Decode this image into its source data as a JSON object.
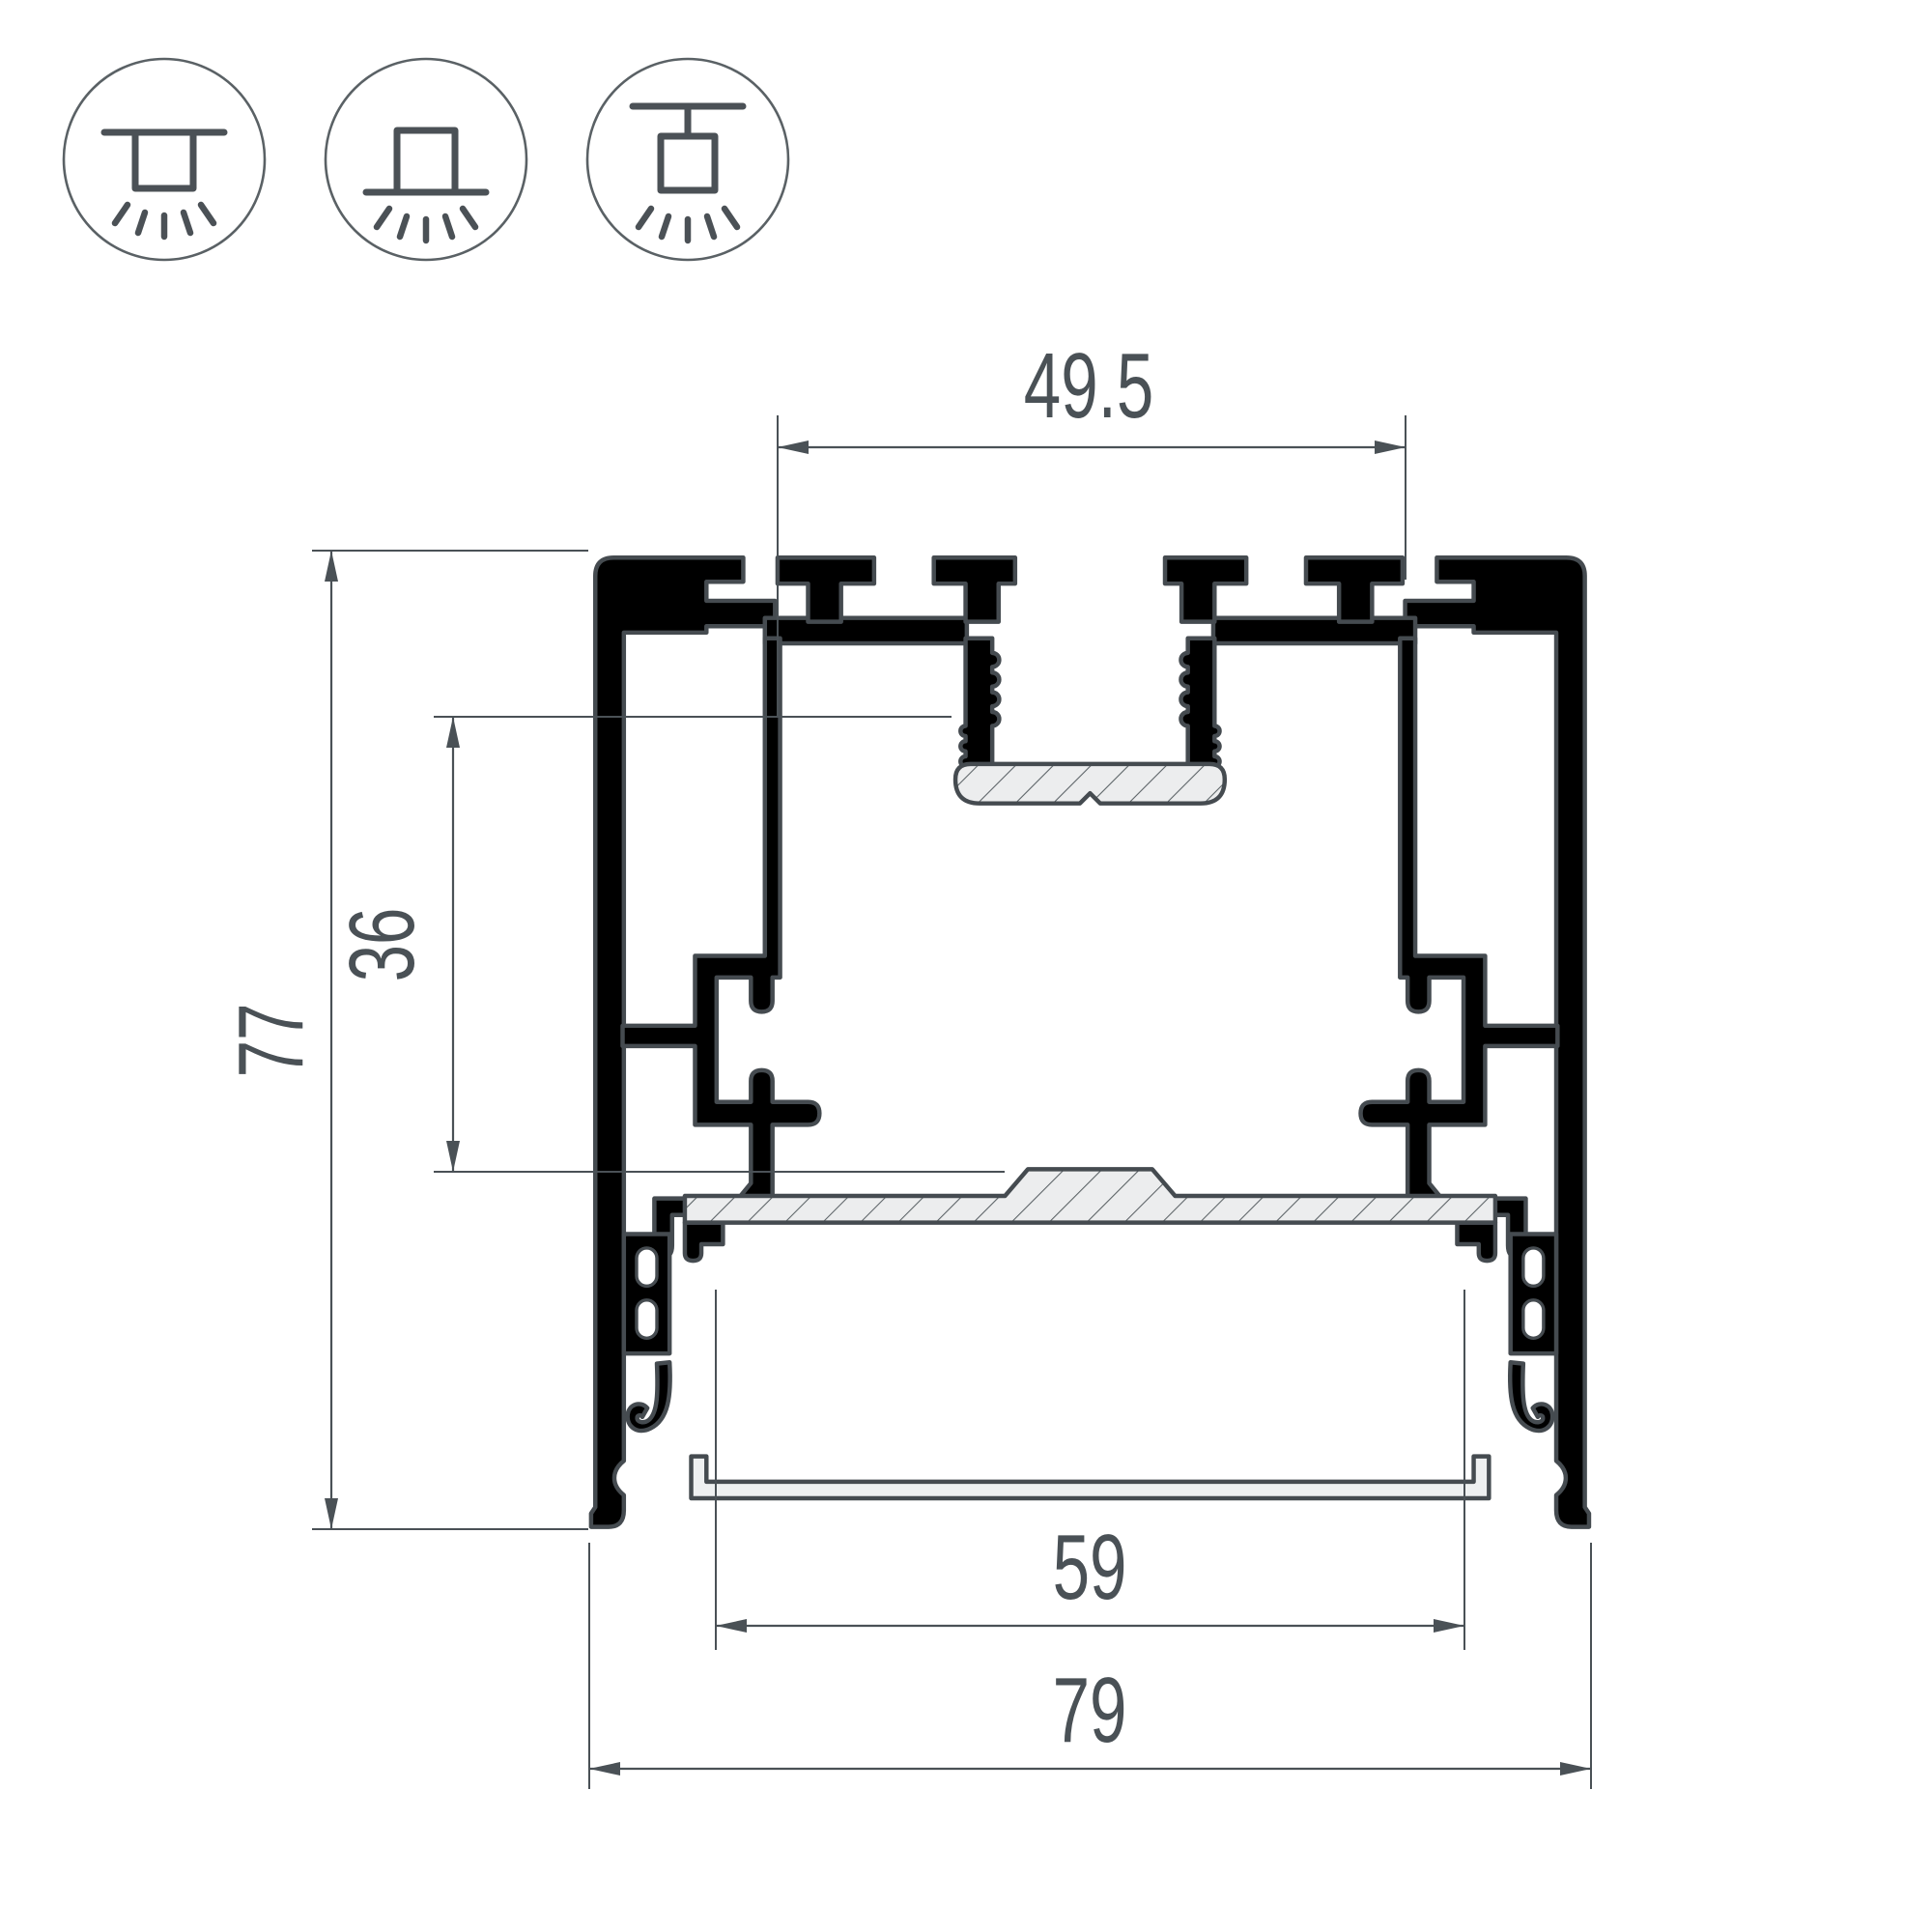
{
  "drawing": {
    "type": "aluminum-led-profile-cross-section",
    "background": "#ffffff",
    "outline_color": "#454b50",
    "metal_fill": "#ecedee",
    "dimension_color": "#4a5156"
  },
  "mount_icons": [
    {
      "name": "recessed-ceiling-mount"
    },
    {
      "name": "surface-ceiling-mount"
    },
    {
      "name": "suspended-pendant-mount"
    }
  ],
  "dimensions": {
    "tab_span": "49.5",
    "overall_height": "77",
    "inner_cavity_height": "36",
    "diffuser_opening_width": "59",
    "overall_width": "79"
  }
}
